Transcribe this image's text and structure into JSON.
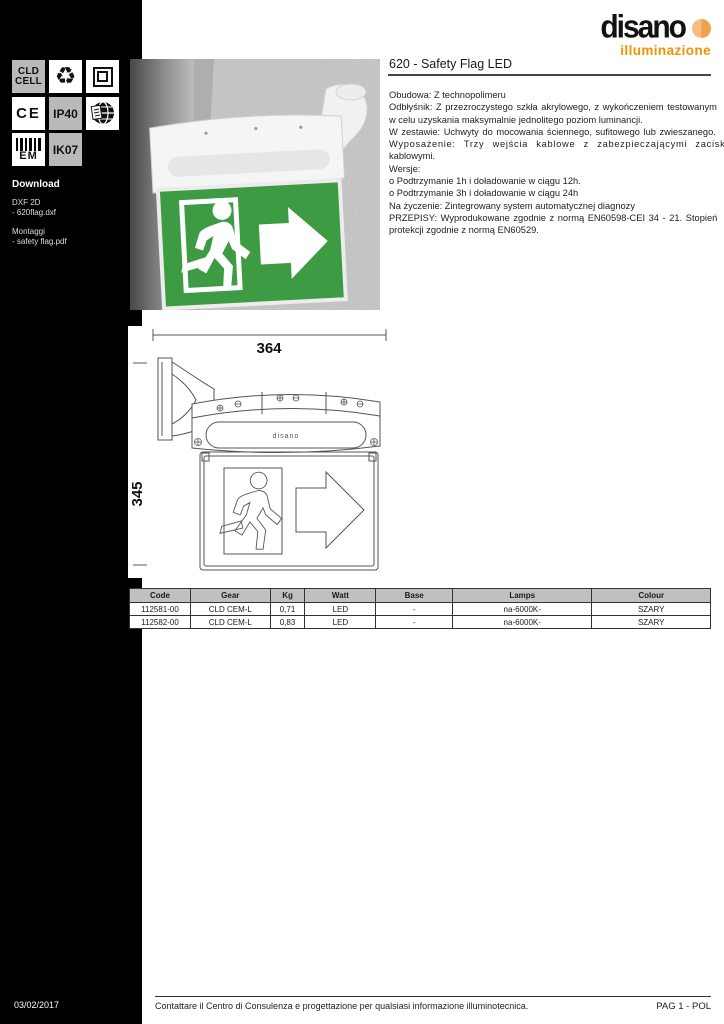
{
  "brand": {
    "name": "disano",
    "subtitle": "illuminazione",
    "accent_orange": "#f39200"
  },
  "sidebar": {
    "badges": {
      "cld_cell_line1": "CLD",
      "cld_cell_line2": "CELL",
      "ce": "CE",
      "ip40": "IP40",
      "em": "EM",
      "ik07": "IK07",
      "icon_names": [
        "recycle-icon",
        "class-ii-double-square-icon",
        "globe-catalog-icon",
        "em-barcode-icon"
      ]
    },
    "download": {
      "title": "Download",
      "dxf_label": "DXF 2D",
      "dxf_file": "- 620flag.dxf",
      "montaggi_label": "Montaggi",
      "montaggi_file": "- safety flag.pdf"
    }
  },
  "header": {
    "title": "620 - Safety Flag LED"
  },
  "description": {
    "lines": [
      "Obudowa: Z technopolimeru",
      "Odbłyśnik: Z przezroczystego szkła akrylowego, z wykończeniem testowanym",
      "w celu uzyskania maksymalnie jednolitego poziom luminancji.",
      "W zestawie: Uchwyty do mocowania ściennego, sufitowego lub zwieszanego.",
      "Wyposażenie: Trzy wejścia kablowe z zabezpieczającymi zaciskami",
      "kablowymi.",
      "Wersje:",
      "o Podtrzymanie 1h i doładowanie w ciągu 12h.",
      "o Podtrzymanie 3h i doładowanie w ciągu 24h",
      "Na życzenie: Zintegrowany system automatycznej diagnozy",
      "PRZEPISY: Wyprodukowane zgodnie z normą EN60598-CEI 34 - 21. Stopień",
      "protekcji zgodnie z normą EN60529."
    ]
  },
  "drawing": {
    "width_mm": "364",
    "height_mm": "345",
    "lens_text": "disano"
  },
  "table": {
    "headers": [
      "Code",
      "Gear",
      "Kg",
      "Watt",
      "Base",
      "Lamps",
      "Colour"
    ],
    "rows": [
      [
        "112581-00",
        "CLD CEM-L",
        "0,71",
        "LED",
        "-",
        "na-6000K-",
        "SZARY"
      ],
      [
        "112582-00",
        "CLD CEM-L",
        "0,83",
        "LED",
        "-",
        "na-6000K-",
        "SZARY"
      ]
    ]
  },
  "footer": {
    "date": "03/02/2017",
    "note": "Contattare il Centro di Consulenza e progettazione per qualsiasi informazione illuminotecnica.",
    "page": "PAG 1 - POL"
  },
  "colors": {
    "sign_green": "#3d9b43",
    "badge_gray": "#b9b9b9",
    "table_header_bg": "#c0c0c0"
  }
}
